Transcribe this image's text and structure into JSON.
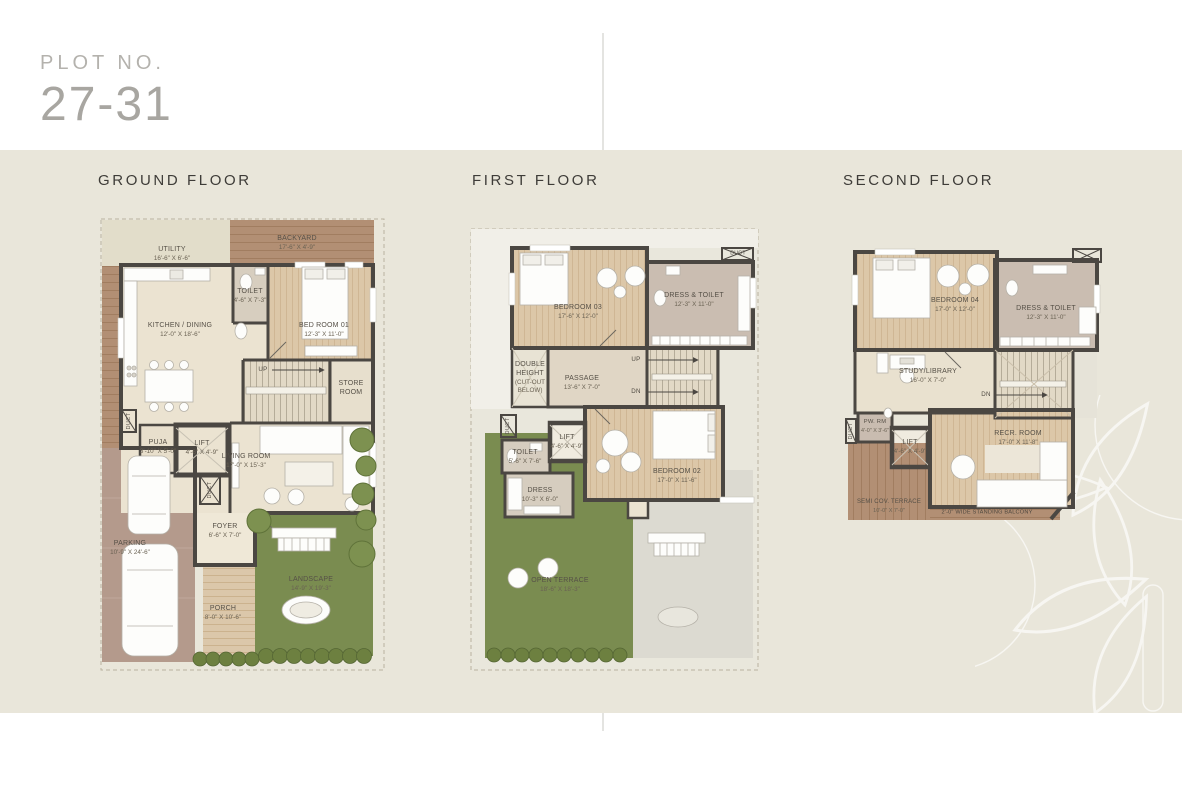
{
  "header": {
    "plot_label": "PLOT NO.",
    "plot_number": "27-31"
  },
  "colors": {
    "panel_beige": "#e9e6da",
    "wall_dark": "#4b4742",
    "wood_deck": "#b28f74",
    "bedroom_wood": "#dcc7a8",
    "landscape_green": "#7a8c50",
    "parking_mauve": "#b49a8c",
    "dress_mauve": "#cabdb1",
    "floor_beige": "#ebe3d1"
  },
  "floors": [
    {
      "title": "GROUND FLOOR",
      "labels": {
        "up": "UP",
        "duct": "DUCT"
      },
      "rooms": [
        {
          "name": "UTILITY",
          "dims": "16'-6\" X 6'-6\""
        },
        {
          "name": "BACKYARD",
          "dims": "17'-6\" X 4'-9\""
        },
        {
          "name": "TOILET",
          "dims": "4'-6\" X 7'-3\""
        },
        {
          "name": "KITCHEN / DINING",
          "dims": "12'-0\" X 18'-6\""
        },
        {
          "name": "BED ROOM 01",
          "dims": "12'-3\" X 11'-0\""
        },
        {
          "name": "STORE ROOM",
          "dims": ""
        },
        {
          "name": "PUJA",
          "dims": "3'-10\" X 5'-0\""
        },
        {
          "name": "LIFT",
          "dims": "4'-6\" X 4'-9\""
        },
        {
          "name": "LIVING ROOM",
          "dims": "17'-0\" X 15'-3\""
        },
        {
          "name": "FOYER",
          "dims": "6'-6\" X 7'-0\""
        },
        {
          "name": "PARKING",
          "dims": "10'-9\" X 24'-6\""
        },
        {
          "name": "PORCH",
          "dims": "8'-0\" X 10'-6\""
        },
        {
          "name": "LANDSCAPE",
          "dims": "14'-9\" X 19'-3\""
        }
      ]
    },
    {
      "title": "FIRST FLOOR",
      "labels": {
        "up": "UP",
        "dn": "DN",
        "duct": "DUCT"
      },
      "rooms": [
        {
          "name": "BEDROOM 03",
          "dims": "17'-6\" X 12'-0\""
        },
        {
          "name": "DRESS & TOILET",
          "dims": "12'-3\" X 11'-0\""
        },
        {
          "name": "DOUBLE HEIGHT",
          "dims": "(CUT-OUT BELOW)"
        },
        {
          "name": "PASSAGE",
          "dims": "13'-6\" X 7'-0\""
        },
        {
          "name": "TOILET",
          "dims": "5'-6\" X 7'-6\""
        },
        {
          "name": "DRESS",
          "dims": "10'-3\" X 6'-0\""
        },
        {
          "name": "LIFT",
          "dims": "4'-6\" X 4'-9\""
        },
        {
          "name": "BEDROOM 02",
          "dims": "17'-0\" X 11'-6\""
        },
        {
          "name": "OPEN TERRACE",
          "dims": "18'-6\" X 18'-3\""
        }
      ]
    },
    {
      "title": "SECOND FLOOR",
      "labels": {
        "dn": "DN",
        "duct": "DUCT",
        "balcony": "2'-0\" WIDE STANDING BALCONY"
      },
      "rooms": [
        {
          "name": "BEDROOM 04",
          "dims": "17'-0\" X 12'-0\""
        },
        {
          "name": "DRESS & TOILET",
          "dims": "12'-3\" X 11'-0\""
        },
        {
          "name": "STUDY/LIBRARY",
          "dims": "16'-0\" X 7'-0\""
        },
        {
          "name": "PW. RM",
          "dims": "4'-0\" X 3'-6\""
        },
        {
          "name": "LIFT",
          "dims": "4'-6\" X 4'-9\""
        },
        {
          "name": "RECR. ROOM",
          "dims": "17'-0\" X 11'-8\""
        },
        {
          "name": "SEMI COV. TERRACE",
          "dims": "10'-0\" X 7'-0\""
        }
      ]
    }
  ]
}
